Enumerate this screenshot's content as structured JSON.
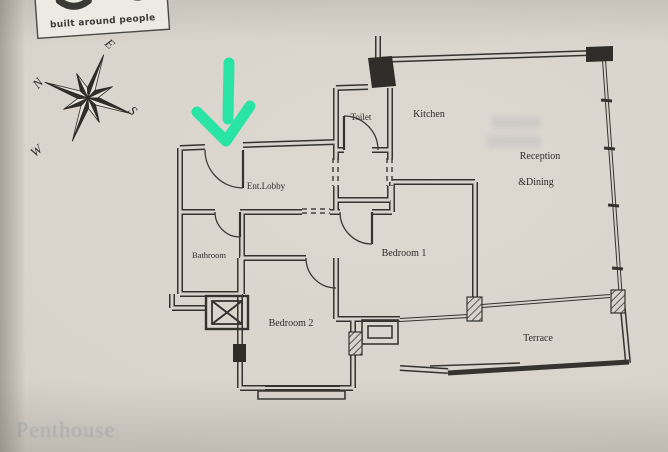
{
  "meta": {
    "description": "Photograph of a printed apartment floor-plan brochure page with a hand-drawn arrow marking the entrance"
  },
  "colors": {
    "paper": "#d8d4cb",
    "ink": "#35332f",
    "annotation_arrow": "#2ae4a6",
    "logo_paper": "#eceae3"
  },
  "logo": {
    "tagline": "built around people"
  },
  "compass": {
    "north": "N",
    "east": "E",
    "south": "S",
    "west": "W"
  },
  "rooms": {
    "toilet": "Toilet",
    "kitchen": "Kitchen",
    "reception_line1": "Reception",
    "reception_line2": "&Dining",
    "ent_lobby": "Ent.Lobby",
    "bathroom": "Bathroom",
    "bedroom1": "Bedroom 1",
    "bedroom2": "Bedroom 2",
    "terrace": "Terrace"
  },
  "bleed_through": {
    "bottom_left": "Penthouse"
  },
  "annotation": {
    "shape": "hand-drawn-down-arrow"
  }
}
